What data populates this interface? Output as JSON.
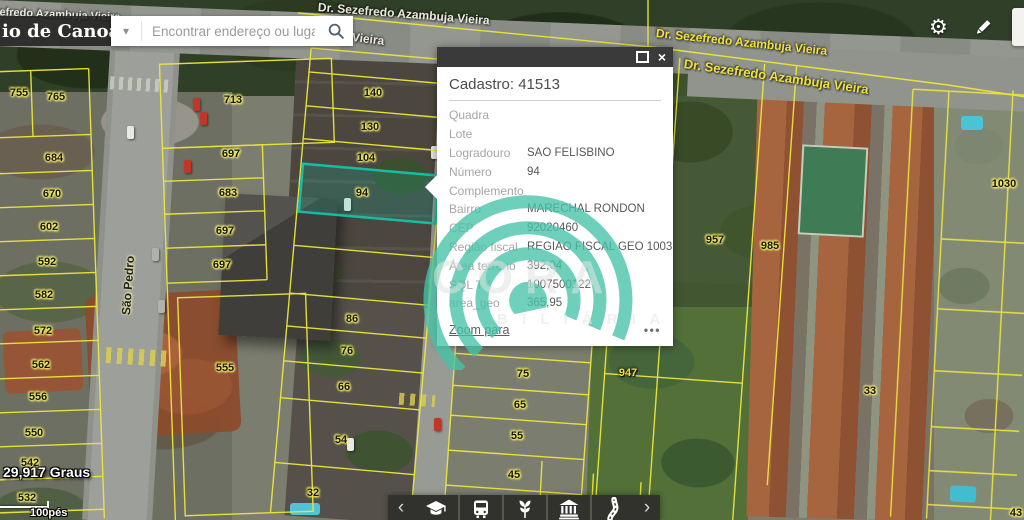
{
  "app": {
    "title": "io de Canoas"
  },
  "search": {
    "placeholder": "Encontrar endereço ou lugar"
  },
  "icons": {
    "gear": "⚙",
    "caret": "▾",
    "prev": "‹",
    "next": "›",
    "close": "×",
    "dots": "•••"
  },
  "popup": {
    "title": "Cadastro: 41513",
    "fields": [
      {
        "label": "Quadra",
        "value": ""
      },
      {
        "label": "Lote",
        "value": ""
      },
      {
        "label": "Logradouro",
        "value": "SAO FELISBINO"
      },
      {
        "label": "Número",
        "value": "94"
      },
      {
        "label": "Complemento",
        "value": ""
      },
      {
        "label": "Bairro",
        "value": "MARECHAL RONDON"
      },
      {
        "label": "CEP",
        "value": "92020460"
      },
      {
        "label": "Região fiscal",
        "value": "REGIAO FISCAL GEO 1003"
      },
      {
        "label": "Área terreno",
        "value": "392,04"
      },
      {
        "label": "SQL TX",
        "value": "1007500122"
      },
      {
        "label": "area_geo",
        "value": "365,95"
      }
    ],
    "zoom_link": "Zoom para"
  },
  "watermark": {
    "brand": "CORA",
    "sub": "B I L I Á R I A",
    "teal": "#46c3a8"
  },
  "toolbar": {
    "items": [
      "education",
      "transport",
      "agriculture",
      "institution",
      "roads"
    ]
  },
  "map": {
    "coordinates": "29,917 Graus",
    "scale_label": "100pés",
    "selected_parcel": "94",
    "colors": {
      "parcel_line": "#ece63c",
      "selected_parcel": "#14c3a9"
    },
    "parcel_labels": [
      {
        "text": "755",
        "x": 19,
        "y": 93
      },
      {
        "text": "765",
        "x": 56,
        "y": 97
      },
      {
        "text": "684",
        "x": 54,
        "y": 158
      },
      {
        "text": "670",
        "x": 52,
        "y": 194
      },
      {
        "text": "602",
        "x": 49,
        "y": 227
      },
      {
        "text": "592",
        "x": 47,
        "y": 262
      },
      {
        "text": "582",
        "x": 44,
        "y": 295
      },
      {
        "text": "572",
        "x": 43,
        "y": 331
      },
      {
        "text": "562",
        "x": 41,
        "y": 365
      },
      {
        "text": "556",
        "x": 38,
        "y": 397
      },
      {
        "text": "550",
        "x": 34,
        "y": 433
      },
      {
        "text": "542",
        "x": 30,
        "y": 463
      },
      {
        "text": "532",
        "x": 27,
        "y": 498
      },
      {
        "text": "713",
        "x": 233,
        "y": 100
      },
      {
        "text": "697",
        "x": 231,
        "y": 154
      },
      {
        "text": "683",
        "x": 228,
        "y": 193
      },
      {
        "text": "697",
        "x": 225,
        "y": 231
      },
      {
        "text": "697",
        "x": 222,
        "y": 265
      },
      {
        "text": "555",
        "x": 225,
        "y": 368
      },
      {
        "text": "140",
        "x": 373,
        "y": 93
      },
      {
        "text": "130",
        "x": 370,
        "y": 127
      },
      {
        "text": "104",
        "x": 366,
        "y": 158
      },
      {
        "text": "94",
        "x": 362,
        "y": 193
      },
      {
        "text": "86",
        "x": 352,
        "y": 319
      },
      {
        "text": "76",
        "x": 347,
        "y": 351
      },
      {
        "text": "66",
        "x": 344,
        "y": 387
      },
      {
        "text": "54",
        "x": 341,
        "y": 440
      },
      {
        "text": "32",
        "x": 313,
        "y": 493
      },
      {
        "text": "89",
        "x": 527,
        "y": 341
      },
      {
        "text": "75",
        "x": 523,
        "y": 374
      },
      {
        "text": "65",
        "x": 520,
        "y": 405
      },
      {
        "text": "55",
        "x": 517,
        "y": 436
      },
      {
        "text": "45",
        "x": 514,
        "y": 475
      },
      {
        "text": "947",
        "x": 628,
        "y": 373,
        "cls": "yellow"
      },
      {
        "text": "957",
        "x": 715,
        "y": 240
      },
      {
        "text": "985",
        "x": 770,
        "y": 246
      },
      {
        "text": "1030",
        "x": 1004,
        "y": 184
      },
      {
        "text": "33",
        "x": 870,
        "y": 391
      },
      {
        "text": "896",
        "x": 566,
        "y": 514
      },
      {
        "text": "986",
        "x": 605,
        "y": 517
      },
      {
        "text": "43",
        "x": 1016,
        "y": 513
      }
    ],
    "street_labels": [
      {
        "text": "zefredo Azambuja Vieira",
        "x": -6,
        "y": 6,
        "rot": 2.5,
        "cls": "light",
        "size": 11
      },
      {
        "text": "Dr. Sezefredo Azambuja Vieira",
        "x": 318,
        "y": 0,
        "rot": 4.5,
        "cls": "light",
        "size": 12
      },
      {
        "text": "Vieira",
        "x": 352,
        "y": 30,
        "rot": 7,
        "cls": "light",
        "size": 12
      },
      {
        "text": "Dr. Sezefredo Azambuja Vieira",
        "x": 656,
        "y": 26,
        "rot": 6,
        "cls": "yellow",
        "size": 12
      },
      {
        "text": "Dr. Sezefredo Azambuja Vieira",
        "x": 684,
        "y": 56,
        "rot": 8,
        "cls": "yellow",
        "size": 13
      },
      {
        "text": "São Pedro",
        "x": 126,
        "y": 308,
        "rot": -86,
        "cls": "dark",
        "size": 12
      }
    ]
  }
}
